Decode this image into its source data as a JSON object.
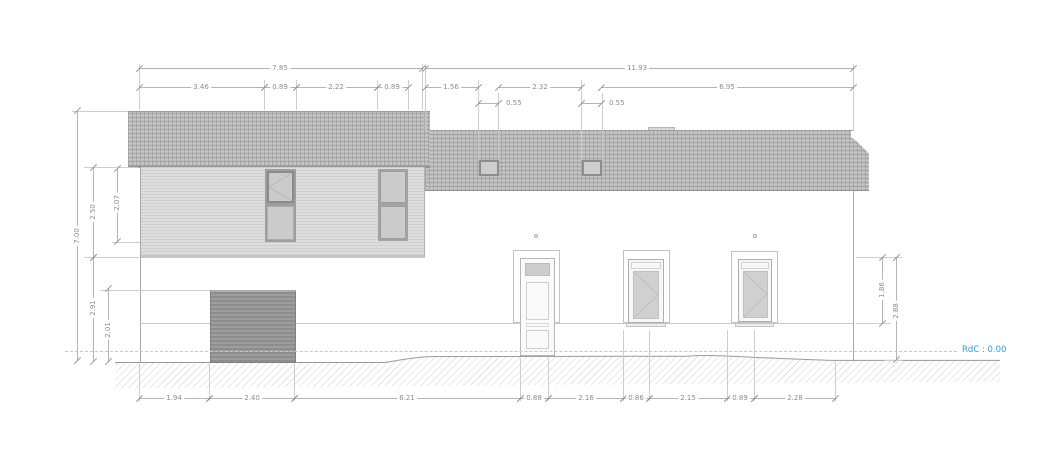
{
  "drawing": {
    "type": "architectural-elevation-facade",
    "level_label": "RdC : 0.00"
  },
  "dimensions": {
    "top_row1": [
      "7.85",
      "11.93"
    ],
    "top_row2": [
      "3.46",
      "0.89",
      "2.22",
      "0.89",
      "1.56",
      "2.32",
      "6.95"
    ],
    "top_row3": [
      "0.55",
      "0.55"
    ],
    "left": [
      "7.00",
      "2.50",
      "2.07",
      "2.91",
      "2.01"
    ],
    "right": [
      "1.86",
      "2.88"
    ],
    "bottom": [
      "1.94",
      "2.40",
      "6.21",
      "0.88",
      "2.16",
      "0.86",
      "2.15",
      "0.89",
      "2.28"
    ]
  },
  "colors": {
    "level_text": "#2b9fd8",
    "level_dash_line": "#a5d3e8",
    "dimension_text": "#8c8c8c",
    "roof_fill": "#bdbdbd",
    "siding_fill": "#d6d6d6",
    "garage_fill": "#949494",
    "ground_hatch": "#c4c4c4"
  }
}
